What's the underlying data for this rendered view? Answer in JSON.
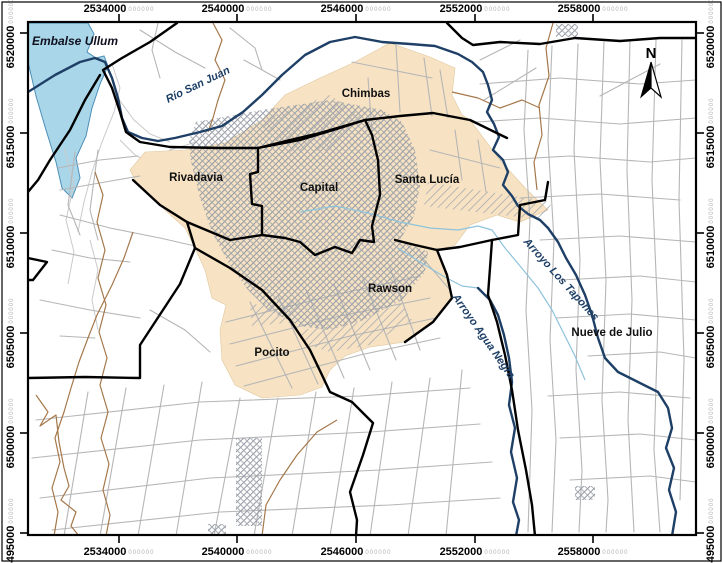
{
  "regions": {
    "chimbas": "Chimbas",
    "rivadavia": "Rivadavia",
    "capital": "Capital",
    "santa_lucia": "Santa Lucía",
    "rawson": "Rawson",
    "pocito": "Pocito",
    "nueve_de_julio": "Nueve de Julio"
  },
  "hydro": {
    "embalse": "Embalse Ullum",
    "rio_san_juan": "Río San Juan",
    "arroyo_tapones": "Arroyo Los Tapones",
    "arroyo_agua_negra": "Arroyo Agua Negra"
  },
  "compass": {
    "north": "N"
  },
  "grid": {
    "x": [
      "2534000",
      "2540000",
      "2546000",
      "2552000",
      "2558000"
    ],
    "y": [
      "6520000",
      "6515000",
      "6510000",
      "6505000",
      "6500000",
      "6495000"
    ],
    "minor": "000000"
  },
  "colors": {
    "water_fill": "#A9D6E8",
    "water_outline": "#4C8FB8",
    "urban_fill": "#F7E3C3",
    "river": "#1E3F66",
    "stream": "#8FC3DC",
    "boundary": "#000000",
    "road": "#B6B6B6",
    "canal": "#A5784B",
    "urban_hatch": "#9298A2"
  }
}
